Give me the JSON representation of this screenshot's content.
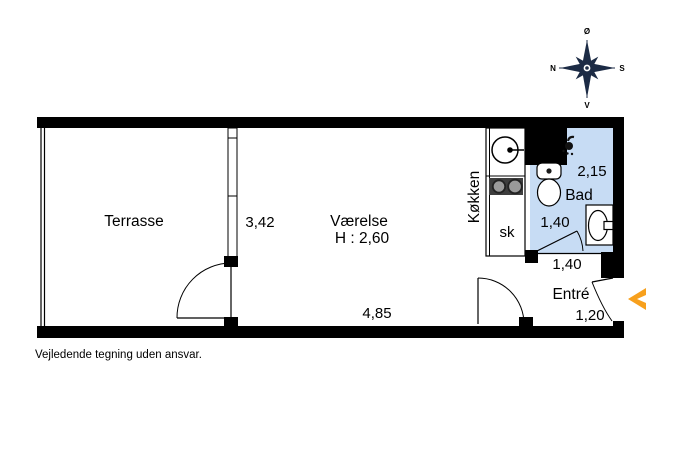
{
  "page": {
    "disclaimer": "Vejledende tegning uden ansvar."
  },
  "compass": {
    "north": "N",
    "south": "S",
    "east": "Ø",
    "west": "V"
  },
  "plan": {
    "terrace": {
      "label": "Terrasse"
    },
    "room": {
      "label": "Værelse",
      "ceiling_height": "H : 2,60",
      "depth": "3,42",
      "width": "4,85"
    },
    "kitchen": {
      "label": "Køkken",
      "closet": "sk"
    },
    "bath": {
      "label": "Bad",
      "depth": "2,15",
      "width": "1,40"
    },
    "entre": {
      "label": "Entré",
      "width": "1,40",
      "depth": "1,20"
    }
  },
  "colors": {
    "bath_fill": "#c7dcf4",
    "entrance_arrow": "#f7a01d",
    "walls": "#000000",
    "compass": "#1c2b45"
  }
}
